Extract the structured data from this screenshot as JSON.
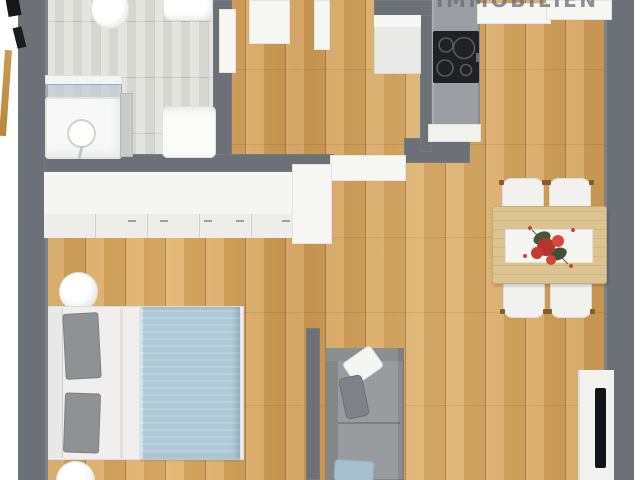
{
  "watermark": {
    "text": "IMMOBILIEN"
  },
  "colors": {
    "wall": "#6c7077",
    "wood": "#d8a75f",
    "tile": "#dbdbd6",
    "grout": "#bfbfb8",
    "counter": "#9b9ea3",
    "cooktop": "#1f2124",
    "blanket": "#aecad8",
    "pillow-gray": "#8f9295",
    "sofa": "#999c9f",
    "table-wood": "#dcc492",
    "tv": "#141518",
    "door-tan": "#c3914b"
  },
  "scene": {
    "type": "3d-floor-plan-top-view",
    "rooms": [
      {
        "name": "bathroom",
        "position": "top-left",
        "floor": "light-gray-tile"
      },
      {
        "name": "hallway",
        "position": "top-center",
        "floor": "oak-wood"
      },
      {
        "name": "kitchen",
        "position": "top-right",
        "floor": "oak-wood"
      },
      {
        "name": "bedroom",
        "position": "left-bottom",
        "floor": "oak-wood"
      },
      {
        "name": "living-room",
        "position": "center-bottom",
        "floor": "oak-wood"
      },
      {
        "name": "dining-area",
        "position": "right-center",
        "floor": "oak-wood"
      }
    ],
    "furniture": [
      {
        "room": "bathroom",
        "items": [
          "toilet",
          "sink",
          "bathtub-with-glass-screen",
          "shower-head",
          "radiator",
          "washing-machine"
        ]
      },
      {
        "room": "hallway",
        "items": [
          "white-door-panels",
          "tall-cabinet"
        ]
      },
      {
        "room": "kitchen",
        "items": [
          "gray-counter-peninsula",
          "cooktop-4-burners",
          "white-upper-counters"
        ]
      },
      {
        "room": "bedroom",
        "items": [
          "wall-wide-white-wardrobe",
          "round-stool-top",
          "double-bed-blue-blanket-gray-pillows",
          "round-stool-bottom",
          "open-white-door"
        ]
      },
      {
        "room": "living-room",
        "items": [
          "gray-sofa-with-pillows",
          "blue-pillow",
          "tv-board-with-wall-tv"
        ]
      },
      {
        "room": "dining-area",
        "items": [
          "wood-dining-table",
          "white-table-runner",
          "red-flower-centerpiece",
          "four-white-chairs"
        ]
      }
    ]
  }
}
